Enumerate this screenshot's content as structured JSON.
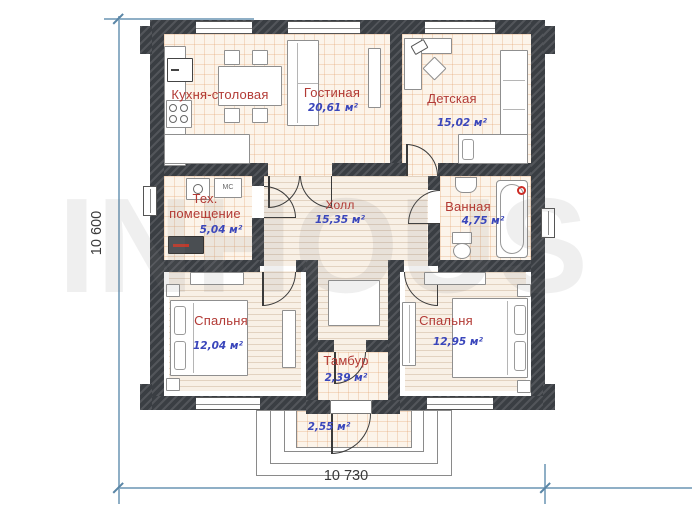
{
  "watermark": "INHOUS",
  "dimensions": {
    "height": "10 600",
    "width": "10 730"
  },
  "rooms": [
    {
      "name": "Кухня-столовая",
      "area": ""
    },
    {
      "name": "Гостиная",
      "area": "20,61 м²"
    },
    {
      "name": "Детская",
      "area": "15,02 м²"
    },
    {
      "name": "Тех. помещение",
      "area": "5,04 м²"
    },
    {
      "name": "Холл",
      "area": "15,35 м²"
    },
    {
      "name": "Ванная",
      "area": "4,75 м²"
    },
    {
      "name": "Спальня",
      "area": "12,04 м²"
    },
    {
      "name": "Спальня",
      "area": "12,95 м²"
    },
    {
      "name": "Тамбур",
      "area": "2,39 м²"
    },
    {
      "name": "",
      "area": "2,55 м²"
    }
  ],
  "labels": {
    "washing_machine": "МС"
  },
  "colors": {
    "room_name": "#b23a35",
    "room_area": "#3a46bb",
    "wall": "#3e4247",
    "dimension": "#8fafc6"
  }
}
